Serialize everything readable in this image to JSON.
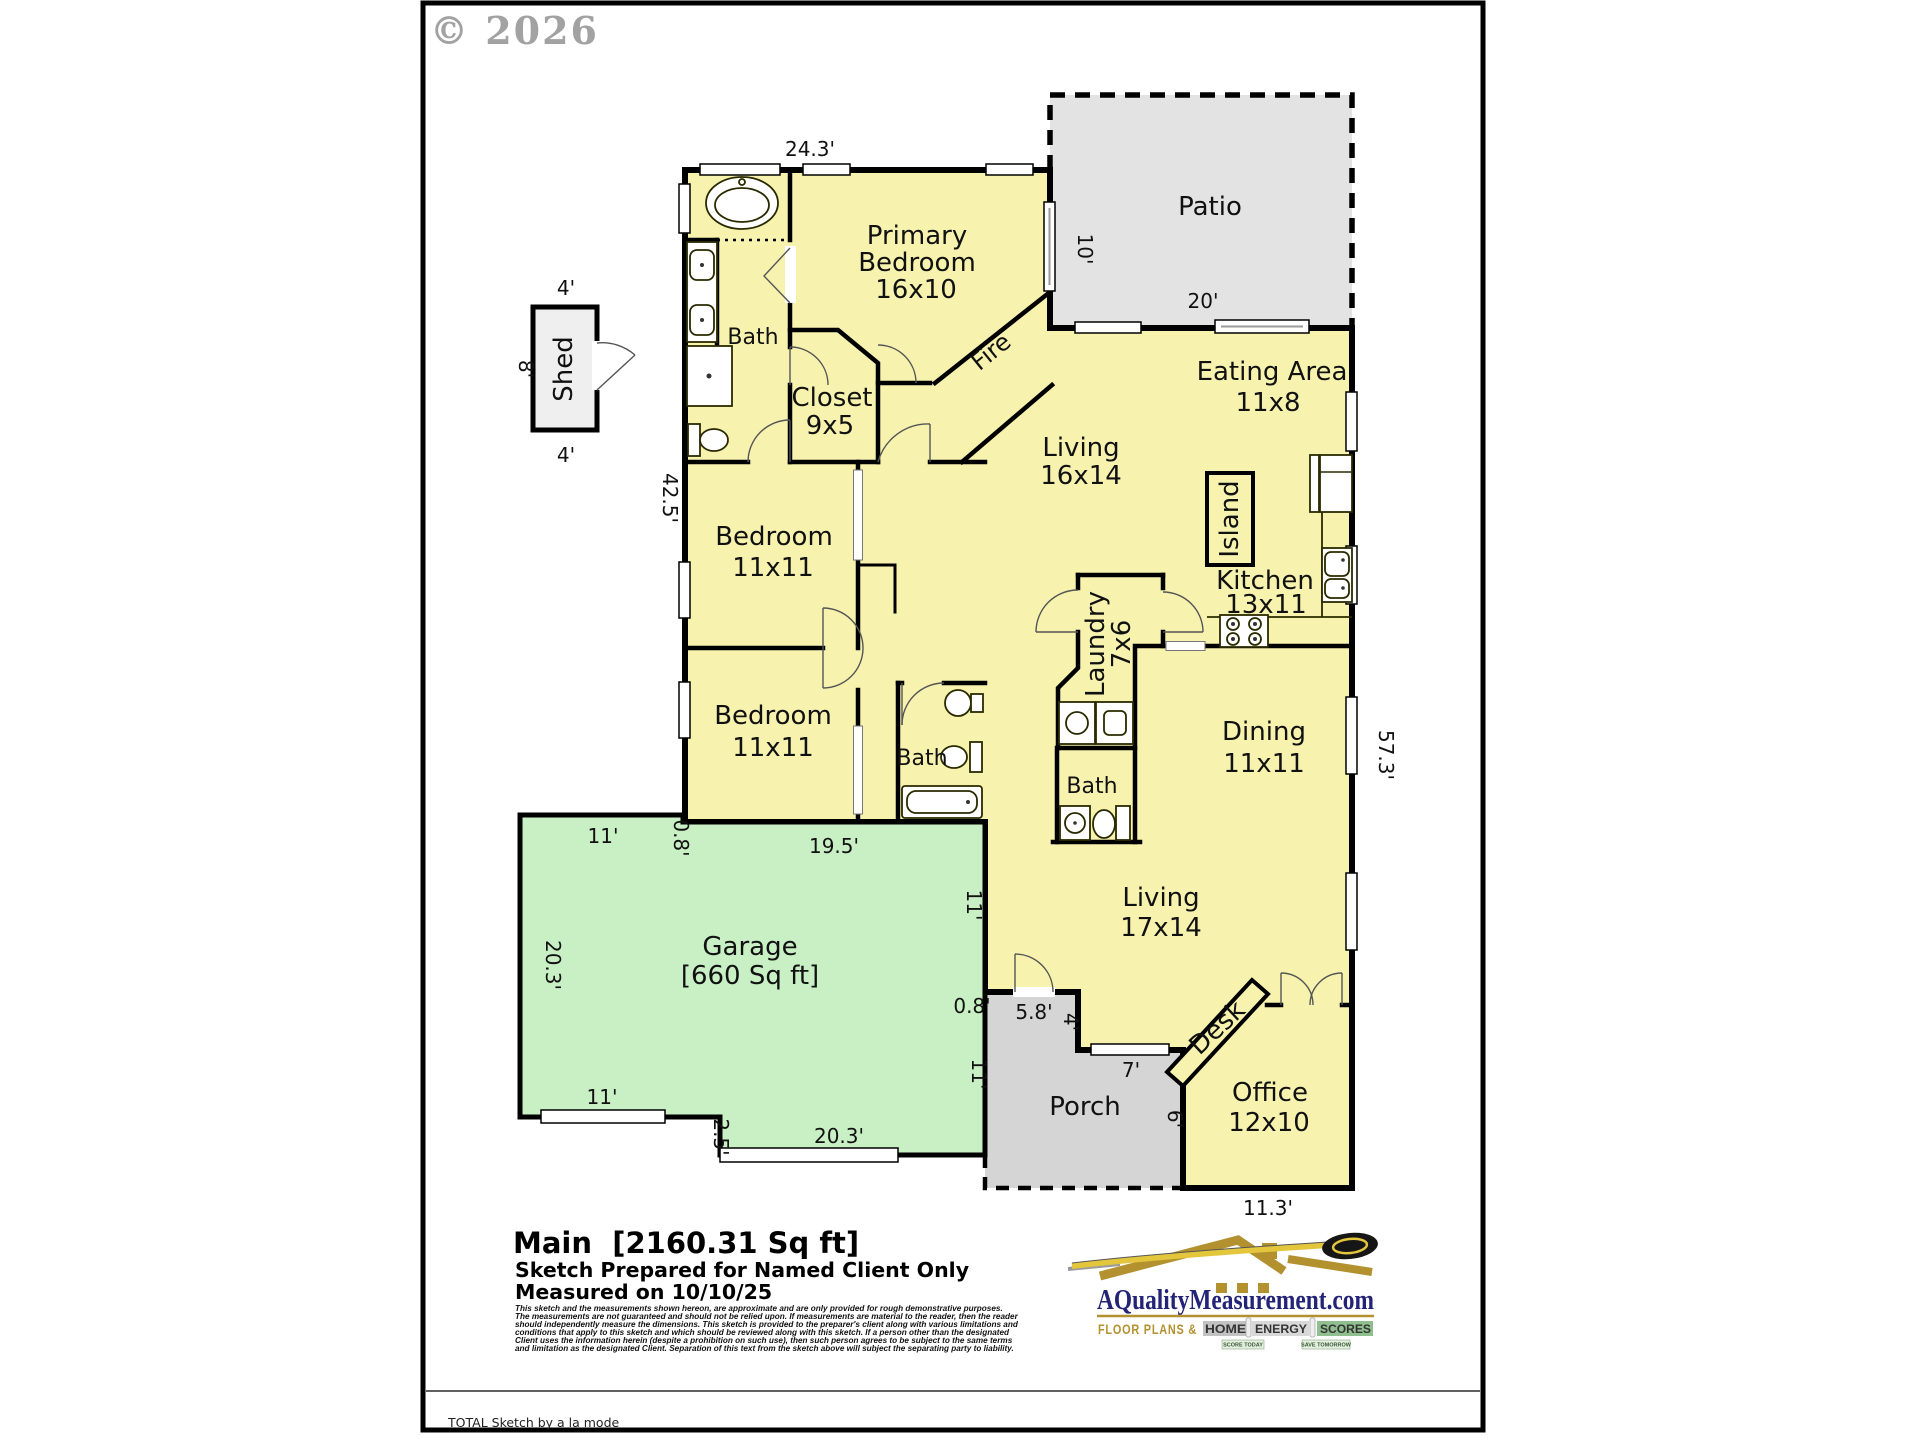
{
  "copyright": "© 2026",
  "colors": {
    "interior_yellow": "#F7F3AF",
    "garage_green": "#C9EFC4",
    "patio_gray": "#E3E3E3",
    "porch_gray": "#D5D5D5",
    "shed_gray": "#EFEFEF",
    "logo_blue": "#232377",
    "logo_gold": "#B3912F"
  },
  "rooms": {
    "primary_bedroom": {
      "l1": "Primary",
      "l2": "Bedroom",
      "size": "16x10"
    },
    "primary_bath": {
      "l1": "Bath"
    },
    "closet": {
      "l1": "Closet",
      "size": "9x5"
    },
    "patio": {
      "l1": "Patio"
    },
    "eating": {
      "l1": "Eating Area",
      "size": "11x8"
    },
    "living_main": {
      "l1": "Living",
      "size": "16x14"
    },
    "island": {
      "l1": "Island"
    },
    "kitchen": {
      "l1": "Kitchen",
      "size": "13x11"
    },
    "bedroom1": {
      "l1": "Bedroom",
      "size": "11x11"
    },
    "bedroom2": {
      "l1": "Bedroom",
      "size": "11x11"
    },
    "laundry": {
      "l1": "Laundry",
      "size": "7x6"
    },
    "hall_bath": {
      "l1": "Bath"
    },
    "dining_bath": {
      "l1": "Bath"
    },
    "dining": {
      "l1": "Dining",
      "size": "11x11"
    },
    "living_family": {
      "l1": "Living",
      "size": "17x14"
    },
    "garage": {
      "l1": "Garage",
      "size": "[660 Sq ft]"
    },
    "porch": {
      "l1": "Porch"
    },
    "office": {
      "l1": "Office",
      "size": "12x10"
    },
    "desk": {
      "l1": "Desk"
    },
    "fireplace": {
      "l1": "Fire"
    },
    "shed": {
      "l1": "Shed"
    }
  },
  "dims": {
    "top": "24.3'",
    "patio_h": "10'",
    "patio_w": "20'",
    "shed_top": "4'",
    "shed_bottom": "4'",
    "shed_side": "8'",
    "left": "42.5'",
    "right": "57.3'",
    "garage_top": "11'",
    "garage_jog": "0.8'",
    "bottom_left": "19.5'",
    "garage_side": "20.3'",
    "garage_door": "11'",
    "garage_step": "2.5'",
    "garage_bottom": "20.3'",
    "garage_right_a": "11'",
    "garage_right_b": "11'",
    "porch_jog": "0.8'",
    "porch_top": "5.8'",
    "porch_step": "4'",
    "porch_w": "7'",
    "porch_h": "6'",
    "office_w": "11.3'"
  },
  "footer": {
    "title": "Main  [2160.31 Sq ft]",
    "prepared": "Sketch Prepared for Named Client Only",
    "measured": "Measured on 10/10/25",
    "disclaimer": [
      "This sketch and the measurements shown hereon, are approximate and are only provided for rough demonstrative purposes.",
      "The measurements are not guaranteed and should not be relied upon.  If measurements are material to the reader, then the reader",
      "should independently measure the dimensions.  This sketch is provided to the preparer's client along with various limitations and",
      "conditions that apply to this sketch and which should be reviewed along with this sketch.  If a person other than the designated",
      "Client uses the information herein (despite a prohibition on such use), then such person agrees to be subject to the same terms",
      "and limitation as the designated Client.  Separation of this text from the sketch above will subject the separating party to liability."
    ],
    "total_credit": "TOTAL Sketch by a la mode"
  },
  "logo": {
    "site": "AQualityMeasurement.com",
    "tag": "FLOOR PLANS &",
    "word1": "HOME",
    "word2": "ENERGY",
    "word3": "SCORES",
    "badge1": "SCORE TODAY",
    "badge2": "SAVE TOMORROW"
  }
}
